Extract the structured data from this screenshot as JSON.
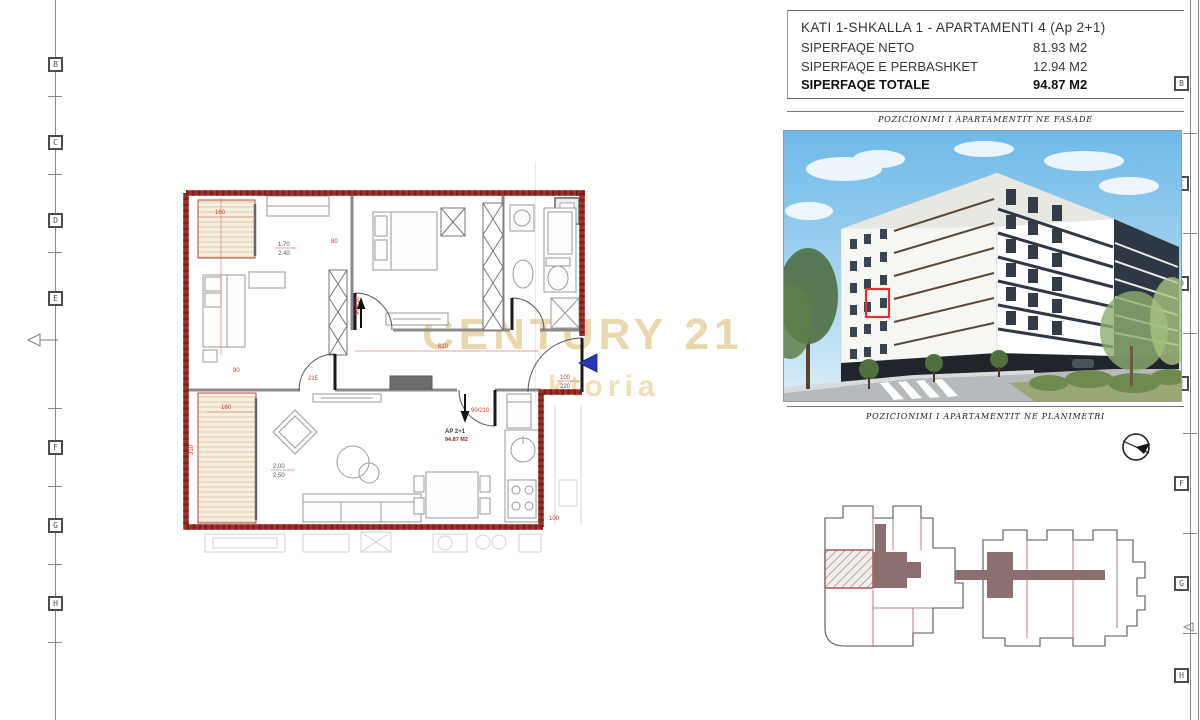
{
  "header": {
    "title": "KATI 1-SHKALLA 1 - APARTAMENTI 4  (Ap 2+1)",
    "rows": [
      {
        "label": "SIPERFAQE NETO",
        "value": "81.93 M2"
      },
      {
        "label": "SIPERFAQE E PERBASHKET",
        "value": "12.94 M2"
      },
      {
        "label": "SIPERFAQE TOTALE",
        "value": "94.87 M2"
      }
    ]
  },
  "captions": {
    "facade": "POZICIONIMI I APARTAMENTIT NE FASADE",
    "planimetri": "POZICIONIMI I APARTAMENTIT NE PLANIMETRI"
  },
  "watermark": {
    "brand": "CENTURY 21",
    "agency": "ktoria"
  },
  "floorplan": {
    "unit_label": "AP 2+1",
    "unit_area": "94.87 M2",
    "dims": {
      "balcony_top_w": "160",
      "frac_top_a": "1.70",
      "frac_top_b": "2.40",
      "dim_80": "80",
      "dim_90": "90",
      "door_b2": "90/210",
      "hall_w": "610",
      "door_liv": "90/210",
      "entry_a": "100",
      "entry_b": "220",
      "frac_left_a": "2.00",
      "frac_left_b": "2.50",
      "balcony_left_h": "310",
      "living_w": "160",
      "dim_215": "215",
      "dim_100": "100"
    }
  },
  "grid": {
    "left": [
      "B",
      "C",
      "D",
      "E",
      "F",
      "G",
      "H"
    ],
    "right": [
      "B",
      "C",
      "D",
      "E",
      "F",
      "G",
      "H"
    ]
  },
  "colors": {
    "wall_red": "#9e2f2b",
    "dim_red": "#c03a30",
    "marker_blue": "#2438b8",
    "watermark_gold": "#e4ce98",
    "site_mauve": "#8c6f71",
    "facade_marker": "#e03030"
  }
}
